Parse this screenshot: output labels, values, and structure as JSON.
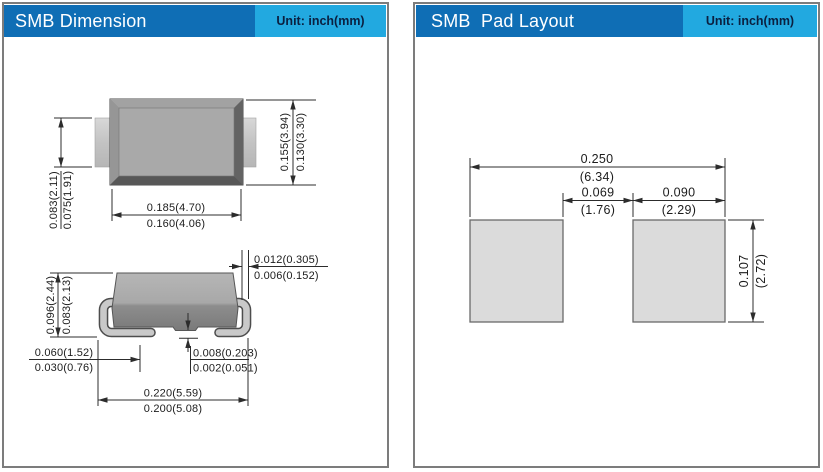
{
  "colors": {
    "header_blue": "#0f6eb5",
    "unit_cyan": "#22a9e0",
    "unit_text": "#0b2040",
    "panel_border_gray": "#7c7c7c",
    "drawing_line": "#2c2c2c",
    "package_gray": "#a9a9a9",
    "pad_fill": "#dbdbdb"
  },
  "left_panel": {
    "title": "SMB Dimension",
    "unit_label": "Unit: inch(mm)",
    "top_view": {
      "lead_width_max": "0.083(2.11)",
      "lead_width_min": "0.075(1.91)",
      "body_width_max": "0.185(4.70)",
      "body_width_min": "0.160(4.06)",
      "body_height_max": "0.155(3.94)",
      "body_height_min": "0.130(3.30)"
    },
    "side_view": {
      "height_max": "0.096(2.44)",
      "height_min": "0.083(2.13)",
      "lead_thickness_max": "0.012(0.305)",
      "lead_thickness_min": "0.006(0.152)",
      "foot_length_max": "0.060(1.52)",
      "foot_length_min": "0.030(0.76)",
      "standoff_max": "0.008(0.203)",
      "standoff_min": "0.002(0.051)",
      "overall_length_max": "0.220(5.59)",
      "overall_length_min": "0.200(5.08)"
    }
  },
  "right_panel": {
    "title": "SMB  Pad Layout",
    "unit_label": "Unit: inch(mm)",
    "pad_layout": {
      "overall_width_inch": "0.250",
      "overall_width_mm": "(6.34)",
      "gap_inch": "0.069",
      "gap_mm": "(1.76)",
      "pad_width_inch": "0.090",
      "pad_width_mm": "(2.29)",
      "pad_height_inch": "0.107",
      "pad_height_mm": "(2.72)"
    }
  }
}
